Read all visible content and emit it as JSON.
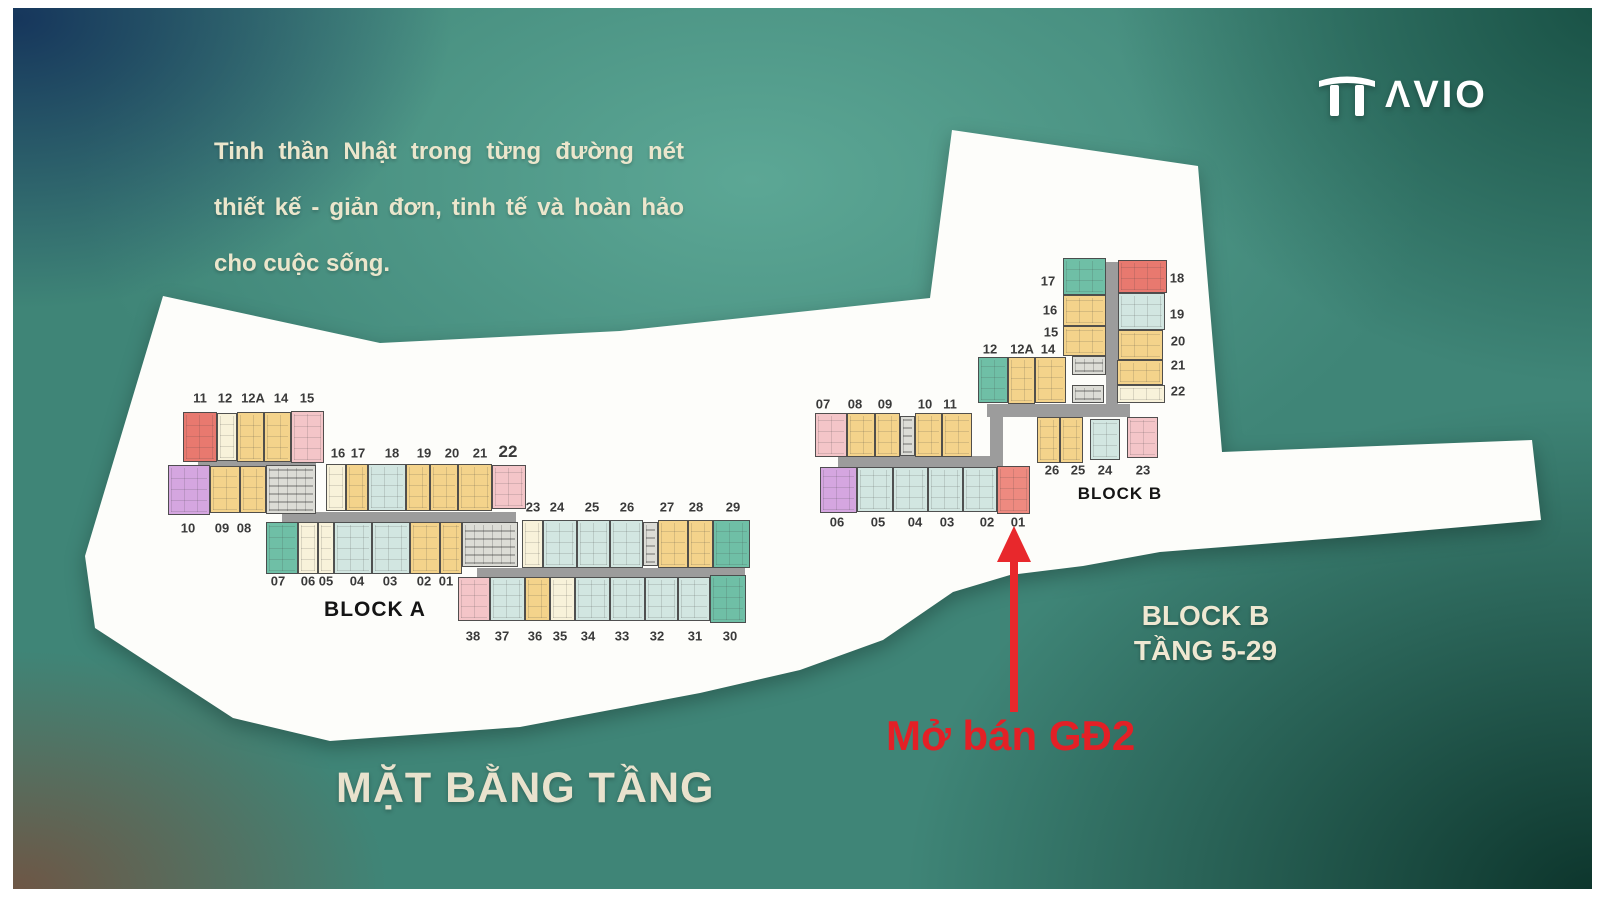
{
  "logo": {
    "text": "ΛVIO"
  },
  "quote": {
    "line1": "Tinh thần Nhật trong từng đường nét",
    "line2": "thiết kế - giản đơn, tinh tế và hoàn hảo",
    "line3": "cho cuộc sống."
  },
  "floor_title": "MẶT BẰNG TẦNG",
  "annotations": {
    "block_b_line1": "BLOCK B",
    "block_b_line2": "TẦNG 5-29",
    "sale": "Mở bán GĐ2",
    "arrow_color": "#e8282c",
    "sale_color": "#e32026"
  },
  "plan": {
    "colors": {
      "red": "#e8796f",
      "salmon": "#ee8a80",
      "pink": "#f4c5c8",
      "cream": "#f8f2da",
      "yellow": "#f4d38b",
      "blue": "#d2e6e1",
      "teal": "#6fbfa6",
      "purple": "#d5a6e0",
      "core": "#dcdcd6",
      "corridor": "#9c9c9c",
      "paper": "#fdfdfa"
    },
    "blocks": [
      {
        "name": "BLOCK A",
        "title": {
          "x": 375,
          "y": 598,
          "size": 21
        },
        "corridors": [
          {
            "x": 198,
            "y": 461,
            "w": 118,
            "h": 10
          },
          {
            "x": 282,
            "y": 512,
            "w": 234,
            "h": 10
          },
          {
            "x": 477,
            "y": 568,
            "w": 268,
            "h": 9
          }
        ],
        "units": [
          {
            "no": "11",
            "c": "red",
            "x": 183,
            "y": 412,
            "w": 34,
            "h": 50
          },
          {
            "no": "12",
            "c": "cream",
            "x": 217,
            "y": 413,
            "w": 20,
            "h": 48
          },
          {
            "no": "12A",
            "c": "yellow",
            "x": 237,
            "y": 412,
            "w": 27,
            "h": 50
          },
          {
            "no": "14",
            "c": "yellow",
            "x": 264,
            "y": 412,
            "w": 27,
            "h": 50
          },
          {
            "no": "15",
            "c": "pink",
            "x": 291,
            "y": 411,
            "w": 33,
            "h": 52
          },
          {
            "no": "10",
            "c": "purple",
            "x": 168,
            "y": 465,
            "w": 42,
            "h": 50
          },
          {
            "no": "09",
            "c": "yellow",
            "x": 210,
            "y": 466,
            "w": 30,
            "h": 47
          },
          {
            "no": "08",
            "c": "yellow",
            "x": 240,
            "y": 466,
            "w": 26,
            "h": 47
          },
          {
            "no": "",
            "c": "core",
            "x": 266,
            "y": 465,
            "w": 50,
            "h": 49
          },
          {
            "no": "16",
            "c": "cream",
            "x": 326,
            "y": 464,
            "w": 20,
            "h": 47
          },
          {
            "no": "17",
            "c": "yellow",
            "x": 346,
            "y": 464,
            "w": 22,
            "h": 47
          },
          {
            "no": "18",
            "c": "blue",
            "x": 368,
            "y": 464,
            "w": 38,
            "h": 47
          },
          {
            "no": "19",
            "c": "yellow",
            "x": 406,
            "y": 464,
            "w": 24,
            "h": 47
          },
          {
            "no": "20",
            "c": "yellow",
            "x": 430,
            "y": 464,
            "w": 28,
            "h": 47
          },
          {
            "no": "21",
            "c": "yellow",
            "x": 458,
            "y": 464,
            "w": 34,
            "h": 47
          },
          {
            "no": "22",
            "c": "pink",
            "x": 492,
            "y": 465,
            "w": 34,
            "h": 44
          },
          {
            "no": "07",
            "c": "teal",
            "x": 266,
            "y": 522,
            "w": 32,
            "h": 52
          },
          {
            "no": "06",
            "c": "cream",
            "x": 298,
            "y": 522,
            "w": 20,
            "h": 52
          },
          {
            "no": "05",
            "c": "cream",
            "x": 318,
            "y": 522,
            "w": 16,
            "h": 52
          },
          {
            "no": "04",
            "c": "blue",
            "x": 334,
            "y": 522,
            "w": 38,
            "h": 52
          },
          {
            "no": "03",
            "c": "blue",
            "x": 372,
            "y": 522,
            "w": 38,
            "h": 52
          },
          {
            "no": "02",
            "c": "yellow",
            "x": 410,
            "y": 522,
            "w": 30,
            "h": 52
          },
          {
            "no": "01",
            "c": "yellow",
            "x": 440,
            "y": 522,
            "w": 22,
            "h": 52
          },
          {
            "no": "",
            "c": "core",
            "x": 462,
            "y": 522,
            "w": 56,
            "h": 45
          },
          {
            "no": "23",
            "c": "cream",
            "x": 522,
            "y": 520,
            "w": 21,
            "h": 48
          },
          {
            "no": "24",
            "c": "blue",
            "x": 543,
            "y": 520,
            "w": 34,
            "h": 48
          },
          {
            "no": "25",
            "c": "blue",
            "x": 577,
            "y": 520,
            "w": 33,
            "h": 48
          },
          {
            "no": "26",
            "c": "blue",
            "x": 610,
            "y": 520,
            "w": 33,
            "h": 48
          },
          {
            "no": "",
            "c": "core",
            "x": 643,
            "y": 522,
            "w": 15,
            "h": 44
          },
          {
            "no": "27",
            "c": "yellow",
            "x": 658,
            "y": 520,
            "w": 30,
            "h": 48
          },
          {
            "no": "28",
            "c": "yellow",
            "x": 688,
            "y": 520,
            "w": 25,
            "h": 48
          },
          {
            "no": "29",
            "c": "teal",
            "x": 713,
            "y": 520,
            "w": 37,
            "h": 48
          },
          {
            "no": "38",
            "c": "pink",
            "x": 458,
            "y": 577,
            "w": 32,
            "h": 44
          },
          {
            "no": "37",
            "c": "blue",
            "x": 490,
            "y": 577,
            "w": 35,
            "h": 44
          },
          {
            "no": "36",
            "c": "yellow",
            "x": 525,
            "y": 577,
            "w": 25,
            "h": 44
          },
          {
            "no": "35",
            "c": "cream",
            "x": 550,
            "y": 577,
            "w": 25,
            "h": 44
          },
          {
            "no": "34",
            "c": "blue",
            "x": 575,
            "y": 577,
            "w": 35,
            "h": 44
          },
          {
            "no": "33",
            "c": "blue",
            "x": 610,
            "y": 577,
            "w": 35,
            "h": 44
          },
          {
            "no": "32",
            "c": "blue",
            "x": 645,
            "y": 577,
            "w": 33,
            "h": 44
          },
          {
            "no": "31",
            "c": "blue",
            "x": 678,
            "y": 577,
            "w": 32,
            "h": 44
          },
          {
            "no": "30",
            "c": "teal",
            "x": 710,
            "y": 575,
            "w": 36,
            "h": 48
          }
        ],
        "labels": [
          {
            "t": "11",
            "x": 200,
            "y": 398
          },
          {
            "t": "12",
            "x": 225,
            "y": 398
          },
          {
            "t": "12A",
            "x": 253,
            "y": 398
          },
          {
            "t": "14",
            "x": 281,
            "y": 398
          },
          {
            "t": "15",
            "x": 307,
            "y": 398
          },
          {
            "t": "10",
            "x": 188,
            "y": 528
          },
          {
            "t": "09",
            "x": 222,
            "y": 528
          },
          {
            "t": "08",
            "x": 244,
            "y": 528
          },
          {
            "t": "16",
            "x": 338,
            "y": 453
          },
          {
            "t": "17",
            "x": 358,
            "y": 453
          },
          {
            "t": "18",
            "x": 392,
            "y": 453
          },
          {
            "t": "19",
            "x": 424,
            "y": 453
          },
          {
            "t": "20",
            "x": 452,
            "y": 453
          },
          {
            "t": "21",
            "x": 480,
            "y": 453
          },
          {
            "t": "22",
            "x": 508,
            "y": 452,
            "s": 17
          },
          {
            "t": "23",
            "x": 533,
            "y": 507
          },
          {
            "t": "24",
            "x": 557,
            "y": 507
          },
          {
            "t": "25",
            "x": 592,
            "y": 507
          },
          {
            "t": "26",
            "x": 627,
            "y": 507
          },
          {
            "t": "27",
            "x": 667,
            "y": 507
          },
          {
            "t": "28",
            "x": 696,
            "y": 507
          },
          {
            "t": "29",
            "x": 733,
            "y": 507
          },
          {
            "t": "07",
            "x": 278,
            "y": 581
          },
          {
            "t": "06",
            "x": 308,
            "y": 581
          },
          {
            "t": "05",
            "x": 326,
            "y": 581
          },
          {
            "t": "04",
            "x": 357,
            "y": 581
          },
          {
            "t": "03",
            "x": 390,
            "y": 581
          },
          {
            "t": "02",
            "x": 424,
            "y": 581
          },
          {
            "t": "01",
            "x": 446,
            "y": 581
          },
          {
            "t": "38",
            "x": 473,
            "y": 636
          },
          {
            "t": "37",
            "x": 502,
            "y": 636
          },
          {
            "t": "36",
            "x": 535,
            "y": 636
          },
          {
            "t": "35",
            "x": 560,
            "y": 636
          },
          {
            "t": "34",
            "x": 588,
            "y": 636
          },
          {
            "t": "33",
            "x": 622,
            "y": 636
          },
          {
            "t": "32",
            "x": 657,
            "y": 636
          },
          {
            "t": "31",
            "x": 695,
            "y": 636
          },
          {
            "t": "30",
            "x": 730,
            "y": 636
          }
        ]
      },
      {
        "name": "BLOCK B",
        "title": {
          "x": 1120,
          "y": 484,
          "size": 17
        },
        "corridors": [
          {
            "x": 1106,
            "y": 262,
            "w": 12,
            "h": 150
          },
          {
            "x": 987,
            "y": 404,
            "w": 143,
            "h": 13
          },
          {
            "x": 990,
            "y": 415,
            "w": 13,
            "h": 52
          },
          {
            "x": 838,
            "y": 456,
            "w": 152,
            "h": 11
          }
        ],
        "units": [
          {
            "no": "17",
            "c": "teal",
            "x": 1063,
            "y": 258,
            "w": 43,
            "h": 37
          },
          {
            "no": "18",
            "c": "red",
            "x": 1118,
            "y": 260,
            "w": 49,
            "h": 33
          },
          {
            "no": "16",
            "c": "yellow",
            "x": 1063,
            "y": 295,
            "w": 43,
            "h": 31
          },
          {
            "no": "15",
            "c": "yellow",
            "x": 1063,
            "y": 326,
            "w": 43,
            "h": 30
          },
          {
            "no": "19",
            "c": "blue",
            "x": 1118,
            "y": 293,
            "w": 47,
            "h": 37
          },
          {
            "no": "20",
            "c": "yellow",
            "x": 1118,
            "y": 330,
            "w": 45,
            "h": 30
          },
          {
            "no": "21",
            "c": "yellow",
            "x": 1117,
            "y": 360,
            "w": 46,
            "h": 25
          },
          {
            "no": "22",
            "c": "cream",
            "x": 1117,
            "y": 385,
            "w": 48,
            "h": 18
          },
          {
            "no": "",
            "c": "core",
            "x": 1072,
            "y": 356,
            "w": 34,
            "h": 19
          },
          {
            "no": "12",
            "c": "teal",
            "x": 978,
            "y": 357,
            "w": 30,
            "h": 46
          },
          {
            "no": "12A",
            "c": "yellow",
            "x": 1008,
            "y": 357,
            "w": 27,
            "h": 47
          },
          {
            "no": "14",
            "c": "yellow",
            "x": 1035,
            "y": 357,
            "w": 31,
            "h": 46
          },
          {
            "no": "",
            "c": "core",
            "x": 1072,
            "y": 385,
            "w": 32,
            "h": 18
          },
          {
            "no": "07",
            "c": "pink",
            "x": 815,
            "y": 413,
            "w": 32,
            "h": 44
          },
          {
            "no": "08",
            "c": "yellow",
            "x": 847,
            "y": 413,
            "w": 28,
            "h": 44
          },
          {
            "no": "09",
            "c": "yellow",
            "x": 875,
            "y": 413,
            "w": 25,
            "h": 44
          },
          {
            "no": "",
            "c": "core",
            "x": 900,
            "y": 416,
            "w": 15,
            "h": 40
          },
          {
            "no": "10",
            "c": "yellow",
            "x": 915,
            "y": 413,
            "w": 27,
            "h": 44
          },
          {
            "no": "11",
            "c": "yellow",
            "x": 942,
            "y": 413,
            "w": 30,
            "h": 44
          },
          {
            "no": "06",
            "c": "purple",
            "x": 820,
            "y": 467,
            "w": 37,
            "h": 46
          },
          {
            "no": "05",
            "c": "blue",
            "x": 857,
            "y": 467,
            "w": 36,
            "h": 45
          },
          {
            "no": "04",
            "c": "blue",
            "x": 893,
            "y": 467,
            "w": 35,
            "h": 45
          },
          {
            "no": "03",
            "c": "blue",
            "x": 928,
            "y": 467,
            "w": 35,
            "h": 45
          },
          {
            "no": "02",
            "c": "blue",
            "x": 963,
            "y": 467,
            "w": 34,
            "h": 45
          },
          {
            "no": "01",
            "c": "salmon",
            "x": 997,
            "y": 466,
            "w": 33,
            "h": 48
          },
          {
            "no": "26",
            "c": "yellow",
            "x": 1037,
            "y": 417,
            "w": 23,
            "h": 46
          },
          {
            "no": "25",
            "c": "yellow",
            "x": 1060,
            "y": 417,
            "w": 23,
            "h": 46
          },
          {
            "no": "24",
            "c": "blue",
            "x": 1090,
            "y": 419,
            "w": 30,
            "h": 41
          },
          {
            "no": "23",
            "c": "pink",
            "x": 1127,
            "y": 417,
            "w": 31,
            "h": 41
          }
        ],
        "labels": [
          {
            "t": "17",
            "x": 1048,
            "y": 281
          },
          {
            "t": "18",
            "x": 1177,
            "y": 278
          },
          {
            "t": "16",
            "x": 1050,
            "y": 310
          },
          {
            "t": "19",
            "x": 1177,
            "y": 314
          },
          {
            "t": "15",
            "x": 1051,
            "y": 332
          },
          {
            "t": "20",
            "x": 1178,
            "y": 341
          },
          {
            "t": "21",
            "x": 1178,
            "y": 365
          },
          {
            "t": "22",
            "x": 1178,
            "y": 391
          },
          {
            "t": "12",
            "x": 990,
            "y": 349
          },
          {
            "t": "12A",
            "x": 1022,
            "y": 349
          },
          {
            "t": "14",
            "x": 1048,
            "y": 349
          },
          {
            "t": "07",
            "x": 823,
            "y": 404
          },
          {
            "t": "08",
            "x": 855,
            "y": 404
          },
          {
            "t": "09",
            "x": 885,
            "y": 404
          },
          {
            "t": "10",
            "x": 925,
            "y": 404
          },
          {
            "t": "11",
            "x": 950,
            "y": 404
          },
          {
            "t": "06",
            "x": 837,
            "y": 522
          },
          {
            "t": "05",
            "x": 878,
            "y": 522
          },
          {
            "t": "04",
            "x": 915,
            "y": 522
          },
          {
            "t": "03",
            "x": 947,
            "y": 522
          },
          {
            "t": "02",
            "x": 987,
            "y": 522
          },
          {
            "t": "01",
            "x": 1018,
            "y": 522
          },
          {
            "t": "26",
            "x": 1052,
            "y": 470
          },
          {
            "t": "25",
            "x": 1078,
            "y": 470
          },
          {
            "t": "24",
            "x": 1105,
            "y": 470
          },
          {
            "t": "23",
            "x": 1143,
            "y": 470
          }
        ]
      }
    ]
  }
}
